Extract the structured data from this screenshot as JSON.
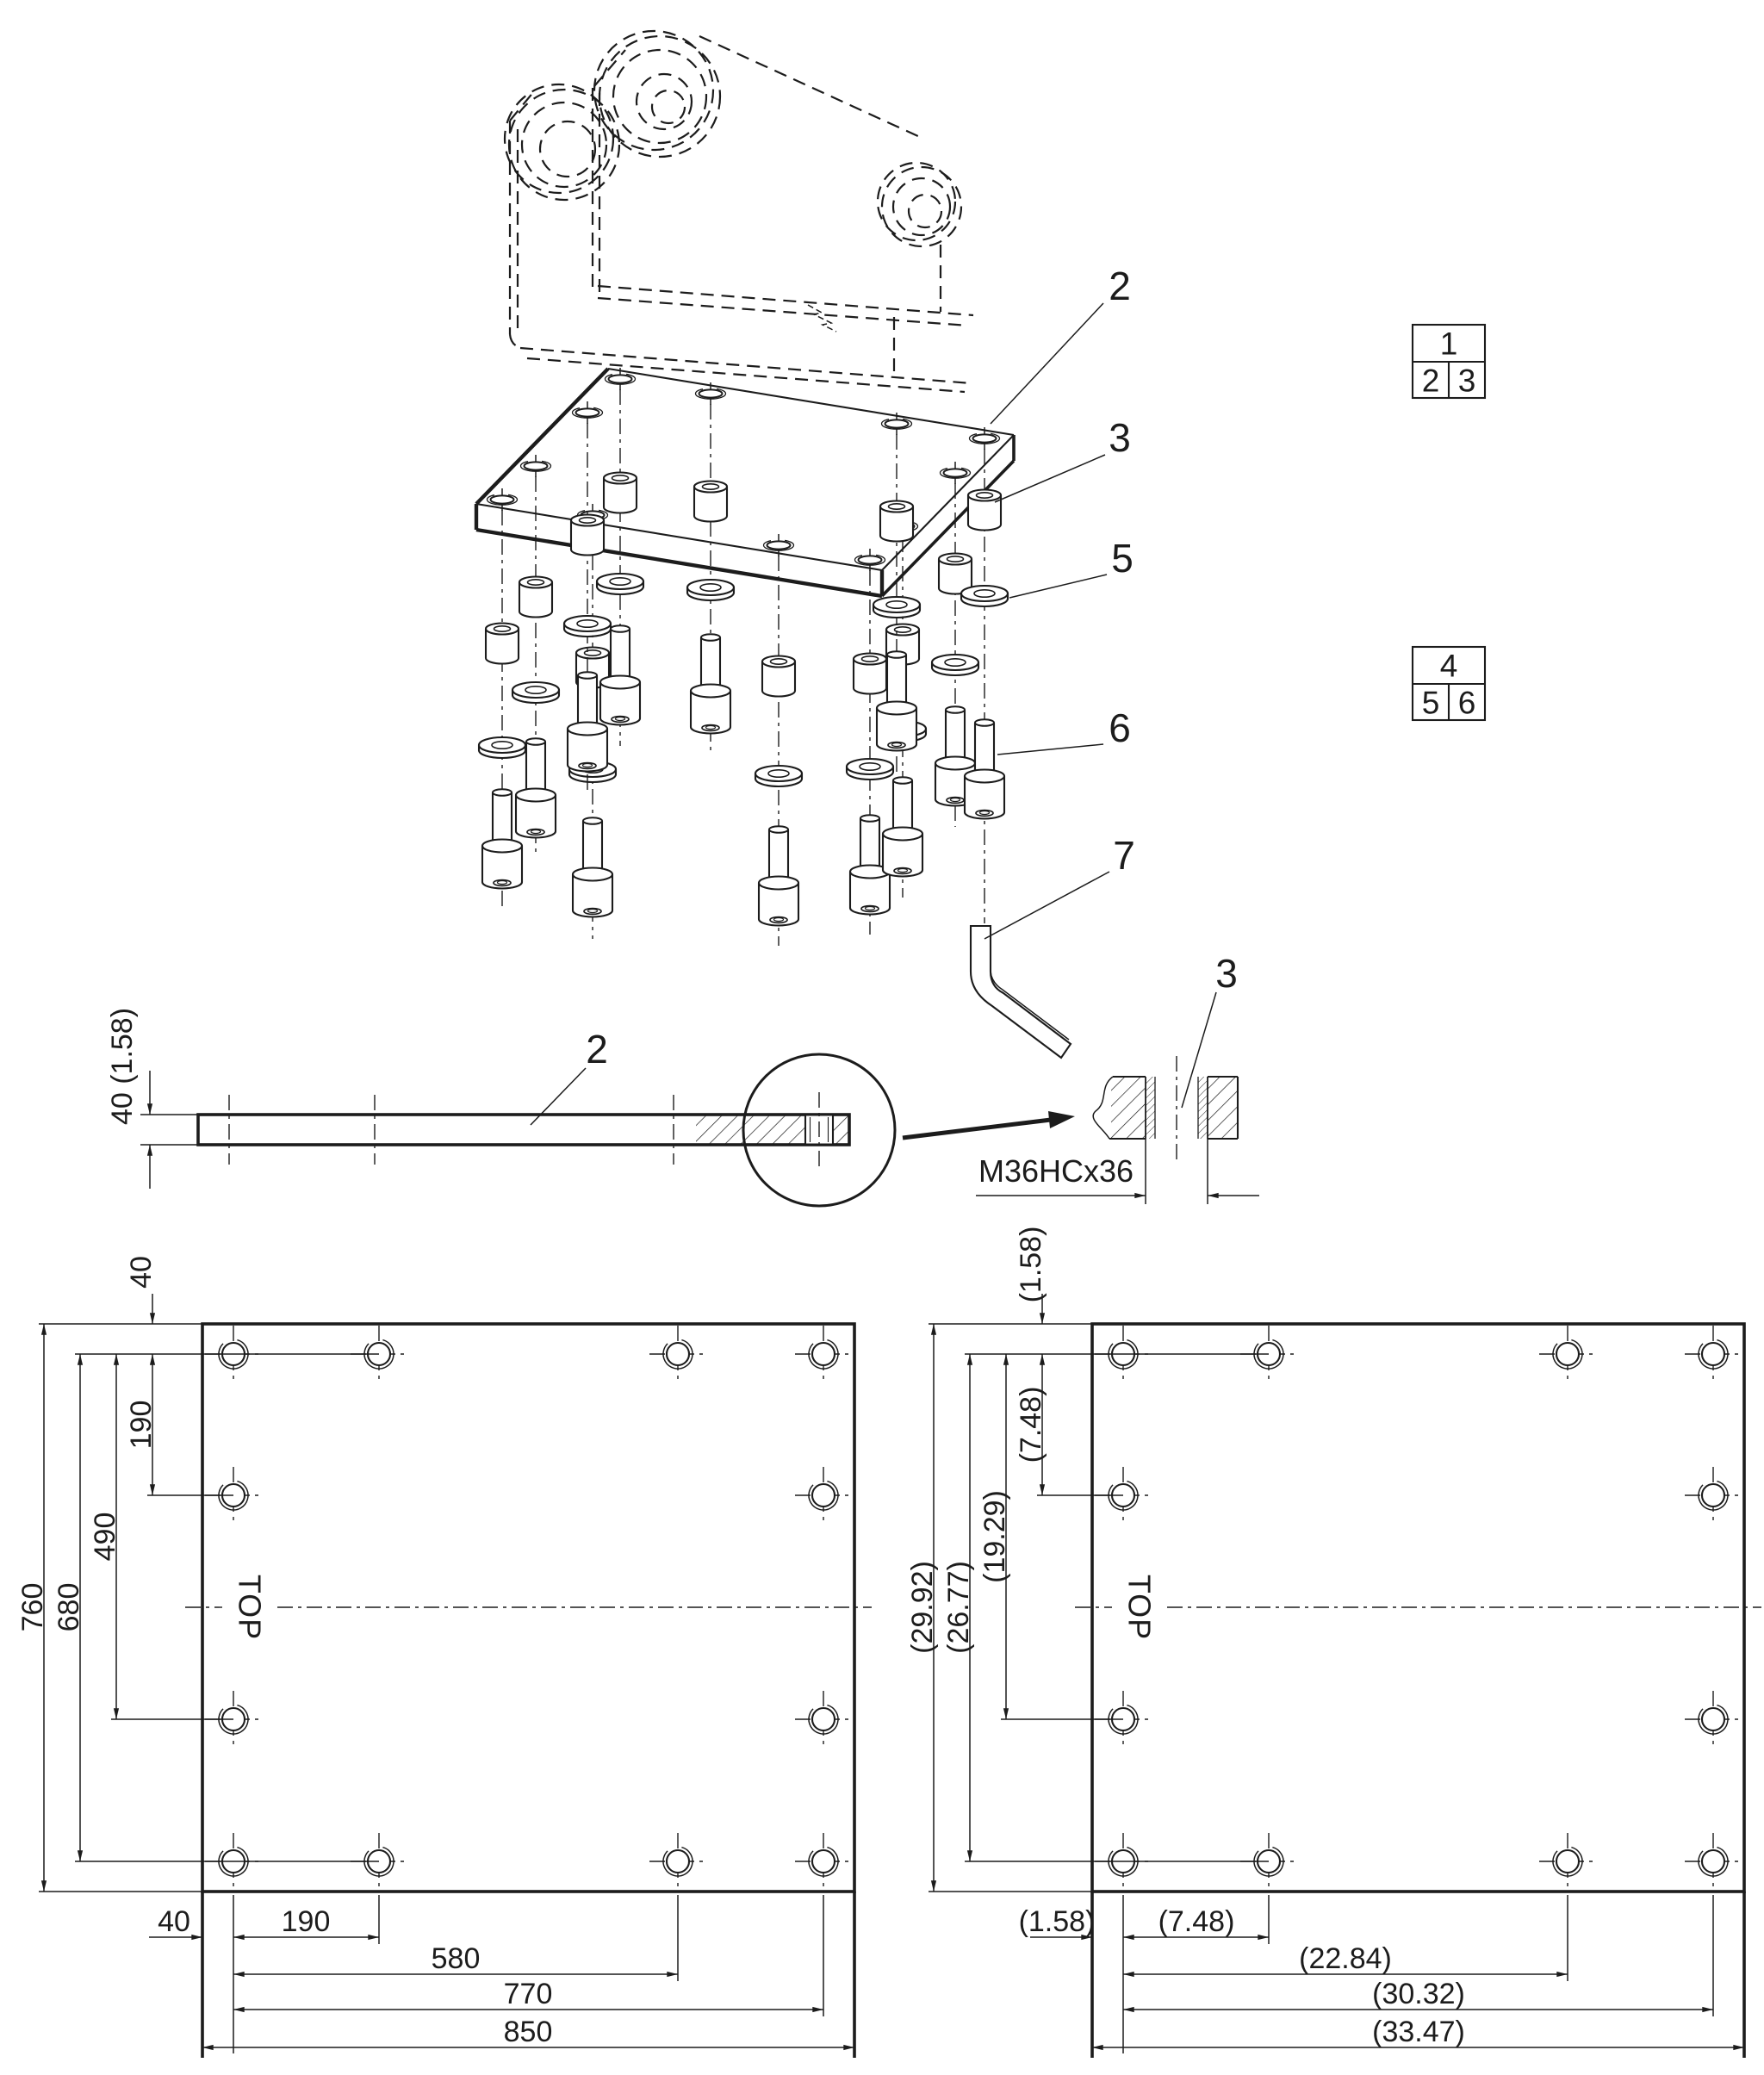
{
  "callouts": {
    "plate": "2",
    "spacer": "3",
    "washer": "5",
    "bolt": "6",
    "hex_key": "7"
  },
  "ref_tables": [
    {
      "parent": "1",
      "children": [
        "2",
        "3"
      ]
    },
    {
      "parent": "4",
      "children": [
        "5",
        "6"
      ]
    }
  ],
  "side_view": {
    "thickness_dim": "40 (1.58)",
    "thread_spec": "M36HCx36"
  },
  "plan_view_mm": {
    "orientation_label": "TOP",
    "dims_vertical": [
      "40",
      "190",
      "490",
      "680",
      "760"
    ],
    "dims_horizontal": [
      "40",
      "190",
      "580",
      "770",
      "850"
    ]
  },
  "plan_view_inch": {
    "orientation_label": "TOP",
    "dims_vertical": [
      "(1.58)",
      "(7.48)",
      "(19.29)",
      "(26.77)",
      "(29.92)"
    ],
    "dims_horizontal": [
      "(1.58)",
      "(7.48)",
      "(22.84)",
      "(30.32)",
      "(33.47)"
    ]
  }
}
